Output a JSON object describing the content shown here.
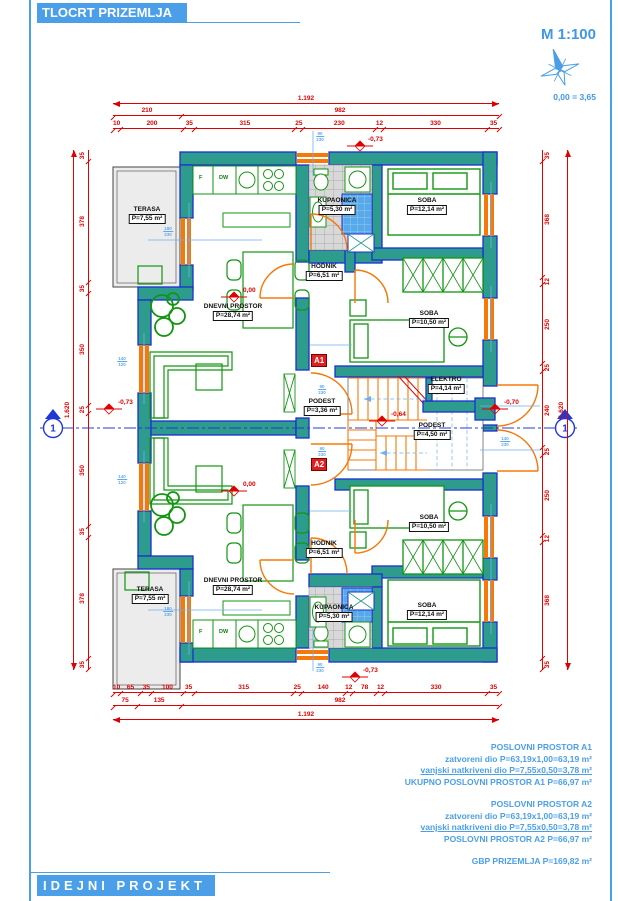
{
  "header": {
    "title": "TLOCRT PRIZEMLJA",
    "scale": "M 1:100",
    "elevation_ref": "0,00 = 3,65"
  },
  "footer": {
    "label": "IDEJNI PROJEKT"
  },
  "rooms": {
    "terasa": {
      "name": "TERASA",
      "area": "P=7,55 m²"
    },
    "dnevni": {
      "name": "DNEVNI PROSTOR",
      "area": "P=28,74 m²"
    },
    "kupaonica": {
      "name": "KUPAONICA",
      "area": "P=5,30 m²"
    },
    "soba_velika": {
      "name": "SOBA",
      "area": "P=12,14 m²"
    },
    "soba_mala": {
      "name": "SOBA",
      "area": "P=10,50 m²"
    },
    "hodnik": {
      "name": "HODNIK",
      "area": "P=6,51 m²"
    },
    "elektro": {
      "name": "ELEKTRO",
      "area": "P=4,14 m²"
    },
    "podest_ulaz": {
      "name": "PODEST",
      "area": "P=3,36 m²"
    },
    "podest_stube": {
      "name": "PODEST",
      "area": "P=4,50 m²"
    }
  },
  "kitchen": {
    "f": "F",
    "dw": "DW"
  },
  "markers": {
    "a1": "A1",
    "a2": "A2",
    "section": "1"
  },
  "levels": {
    "zero": "0,00",
    "m064": "-0,64",
    "m070": "-0,70",
    "m073": "-0,73"
  },
  "dims": {
    "top": {
      "total": "1.192",
      "row2": [
        "210",
        "982"
      ],
      "row3": [
        "10",
        "200",
        "35",
        "315",
        "25",
        "230",
        "12",
        "330",
        "35"
      ]
    },
    "bottom": {
      "row1": [
        "10",
        "65",
        "35",
        "100",
        "35",
        "315",
        "25",
        "140",
        "12",
        "78",
        "12",
        "330",
        "35"
      ],
      "row2": [
        "75",
        "135",
        "982"
      ],
      "total": "1.192"
    },
    "left": {
      "total": "1.620",
      "segs": [
        "35",
        "378",
        "35",
        "350",
        "25",
        "350",
        "35",
        "378",
        "35"
      ]
    },
    "right": {
      "total": "1.620",
      "segs": [
        "35",
        "368",
        "12",
        "250",
        "25",
        "240",
        "25",
        "250",
        "12",
        "368",
        "35"
      ]
    }
  },
  "opening_marks": [
    {
      "w": "90",
      "h": "230"
    },
    {
      "w": "180",
      "h": "230"
    },
    {
      "w": "140",
      "h": "120"
    },
    {
      "w": "140",
      "h": "120"
    },
    {
      "w": "180",
      "h": "230"
    },
    {
      "w": "90",
      "h": "230"
    },
    {
      "w": "90",
      "h": "230"
    },
    {
      "w": "90",
      "h": "230"
    },
    {
      "w": "90",
      "h": "230"
    },
    {
      "w": "140",
      "h": "230"
    }
  ],
  "summary": {
    "a1_title": "POSLOVNI PROSTOR A1",
    "a1_l1": "zatvoreni dio P=63,19x1,00=63,19 m²",
    "a1_l2": "vanjski natkriveni dio P=7,55x0,50=3,78 m²",
    "a1_total": "UKUPNO POSLOVNI PROSTOR A1 P=66,97 m²",
    "a2_title": "POSLOVNI PROSTOR A2",
    "a2_l1": "zatvoreni dio P=63,19x1,00=63,19 m²",
    "a2_l2": "vanjski natkriveni dio P=7,55x0,50=3,78 m²",
    "a2_total": "POSLOVNI PROSTOR A2 P=66,97 m²",
    "gbp": "GBP PRIZEMLJA P=169,82 m²"
  },
  "colors": {
    "accent_blue": "#4A9FE8",
    "dim_red": "#E00000",
    "wall_teal": "#2E9C8D",
    "wall_outline": "#1B2FD1",
    "joinery_orange": "#F67808",
    "furniture_green": "#129612"
  }
}
